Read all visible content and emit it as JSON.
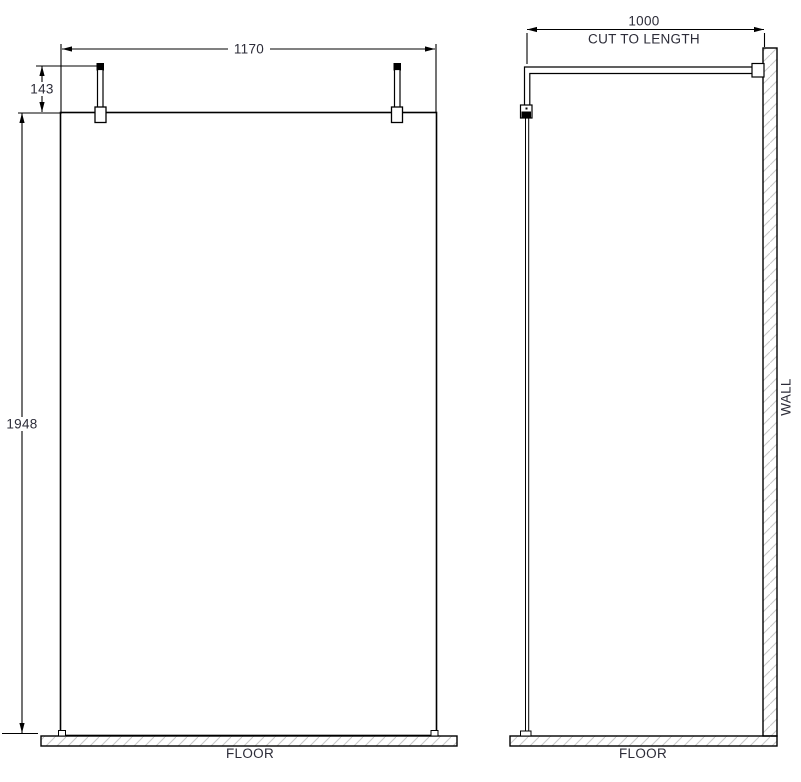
{
  "front_view": {
    "width_dim": "1170",
    "post_height_dim": "143",
    "height_dim": "1948",
    "floor_label": "FLOOR"
  },
  "side_view": {
    "depth_dim": "1000",
    "depth_dim_note": "CUT TO LENGTH",
    "wall_label": "WALL",
    "floor_label": "FLOOR"
  },
  "colors": {
    "line": "#000000",
    "text": "#2c2c38",
    "hatch": "#c9c9c9",
    "background": "#ffffff"
  }
}
